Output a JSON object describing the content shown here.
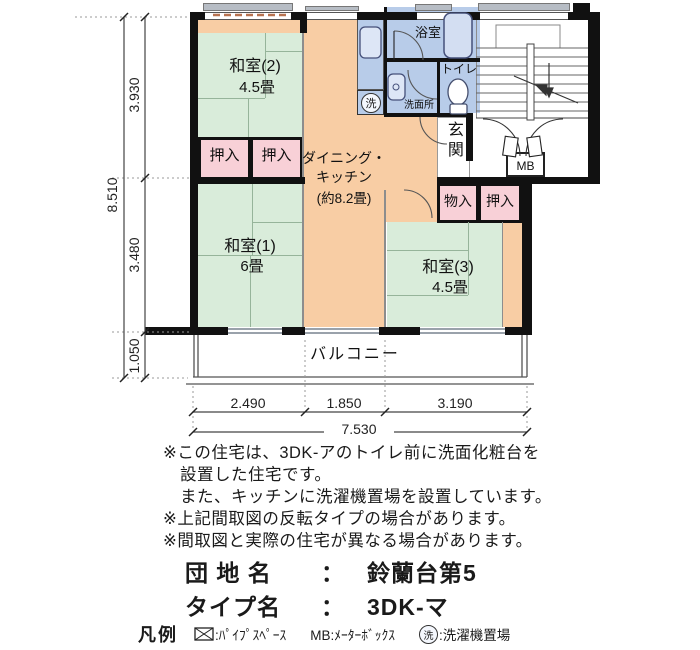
{
  "plan": {
    "rooms": {
      "washitsu2": {
        "name": "和室(2)",
        "size": "4.5畳"
      },
      "washitsu1": {
        "name": "和室(1)",
        "size": "6畳"
      },
      "washitsu3": {
        "name": "和室(3)",
        "size": "4.5畳"
      },
      "dk": {
        "name_line1": "ダイニング・",
        "name_line2": "キッチン",
        "size": "(約8.2畳)"
      },
      "bath": {
        "name": "浴室"
      },
      "toilet": {
        "name": "トイレ"
      },
      "washroom": {
        "name": "洗面所"
      },
      "entrance": {
        "name": "玄関"
      },
      "balcony": {
        "name": "バルコニー"
      },
      "closet_a": {
        "name": "押入"
      },
      "closet_b": {
        "name": "押入"
      },
      "closet_c": {
        "name": "押入"
      },
      "storage": {
        "name": "物入"
      },
      "meter_box": {
        "name": "MB"
      },
      "laundry_symbol": "洗"
    },
    "colors": {
      "tatami": "#d9ecda",
      "dk": "#f8cda4",
      "closet": "#f8d0d7",
      "wet": "#b8cce9",
      "wall": "#111111"
    }
  },
  "dimensions": {
    "total_height": "8.510",
    "height_segments": [
      "3.930",
      "3.480",
      "1.050"
    ],
    "width_segments": [
      "2.490",
      "1.850",
      "3.190"
    ],
    "total_width": "7.530"
  },
  "notes": [
    "※この住宅は、3DK-アのトイレ前に洗面化粧台を",
    "設置した住宅です。",
    "また、キッチンに洗濯機置場を設置しています。",
    "※上記間取図の反転タイプの場合があります。",
    "※間取図と実際の住宅が異なる場合があります。"
  ],
  "property": {
    "estate_label": "団 地 名",
    "separator": "：",
    "estate_name": "鈴蘭台第5",
    "type_label": "タイプ名",
    "type_name": "3DK-マ"
  },
  "legend": {
    "title": "凡例",
    "pipe_space": {
      "symbol": "⊠",
      "label": ":ﾊﾟｲﾌﾟｽﾍﾟｰｽ"
    },
    "meter_box": {
      "label": "MB:ﾒｰﾀｰﾎﾞｯｸｽ"
    },
    "laundry": {
      "symbol": "洗",
      "label": ":洗濯機置場"
    }
  }
}
